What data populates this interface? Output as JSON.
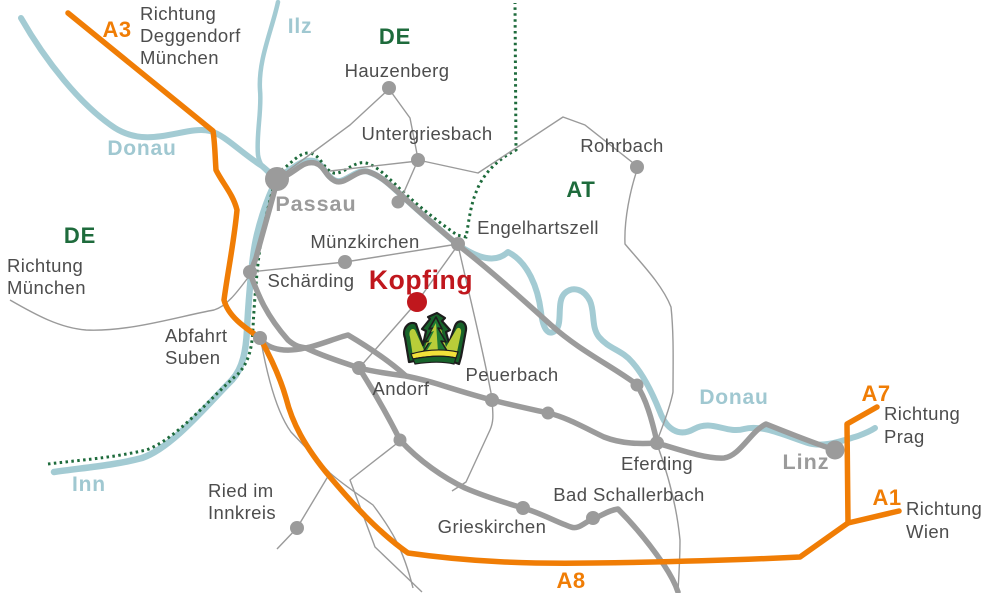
{
  "palette": {
    "river": "#a3cbd3",
    "river_label": "#a0c8d1",
    "border_green": "#1e6b3c",
    "highway_orange": "#f07d05",
    "road_gray": "#9b9b9b",
    "town_text": "#4d4d4d",
    "city_label_gray": "#9b9b9b",
    "destination_red": "#c0171d"
  },
  "regions": {
    "de_north": "DE",
    "de_west": "DE",
    "at": "AT"
  },
  "rivers": {
    "donau_upper": "Donau",
    "donau_lower": "Donau",
    "ilz": "Ilz",
    "inn": "Inn"
  },
  "highways": {
    "a3": "A3",
    "a7": "A7",
    "a1": "A1",
    "a8": "A8"
  },
  "directions": {
    "a3": {
      "line1": "Richtung",
      "line2": "Deggendorf",
      "line3": "München"
    },
    "muenchen": {
      "line1": "Richtung",
      "line2": "München"
    },
    "prag": {
      "line1": "Richtung",
      "line2": "Prag"
    },
    "wien": {
      "line1": "Richtung",
      "line2": "Wien"
    }
  },
  "destination": {
    "name": "Kopfing"
  },
  "towns": {
    "passau": "Passau",
    "linz": "Linz",
    "hauzenberg": "Hauzenberg",
    "untergriesbach": "Untergriesbach",
    "rohrbach": "Rohrbach",
    "engelhartszell": "Engelhartszell",
    "muenzkirchen": "Münzkirchen",
    "schaerding": "Schärding",
    "andorf": "Andorf",
    "peuerbach": "Peuerbach",
    "eferding": "Eferding",
    "grieskirchen": "Grieskirchen",
    "bad_schallerbach": "Bad Schallerbach"
  },
  "poi": {
    "abfahrt_suben": {
      "line1": "Abfahrt",
      "line2": "Suben"
    },
    "ried": {
      "line1": "Ried im",
      "line2": "Innkreis"
    }
  },
  "icons": {
    "logo": "crown-trees-logo",
    "destination_marker": "red-dot-marker"
  }
}
